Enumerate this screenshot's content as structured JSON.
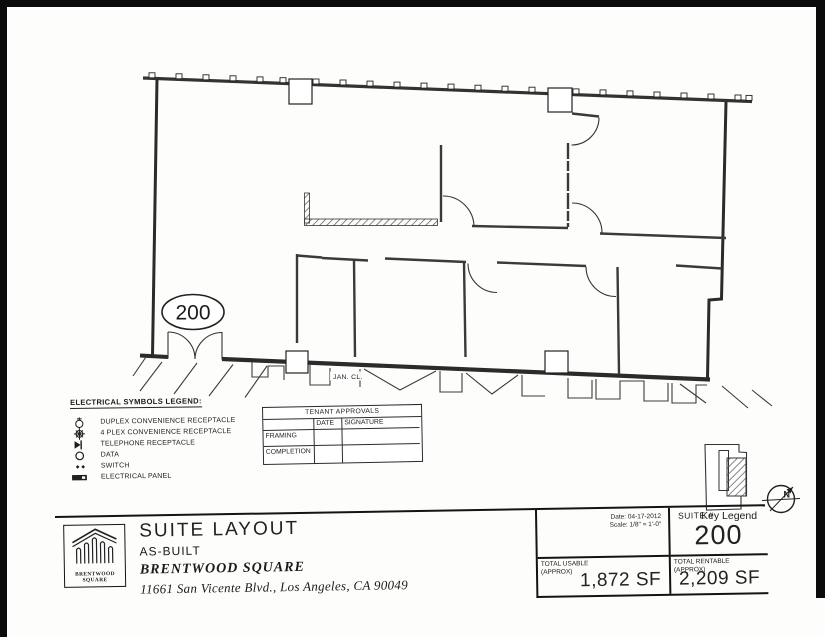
{
  "drawing": {
    "suite_bubble": "200",
    "room_label_jan_closet": "JAN. CL."
  },
  "electrical_legend": {
    "title": "ELECTRICAL SYMBOLS LEGEND:",
    "items": [
      {
        "icon": "duplex-receptacle-symbol",
        "label": "DUPLEX CONVENIENCE RECEPTACLE"
      },
      {
        "icon": "quad-receptacle-symbol",
        "label": "4 PLEX CONVENIENCE RECEPTACLE"
      },
      {
        "icon": "telephone-receptacle-symbol",
        "label": "TELEPHONE RECEPTACLE"
      },
      {
        "icon": "data-symbol",
        "label": "DATA"
      },
      {
        "icon": "switch-symbol",
        "label": "SWITCH"
      },
      {
        "icon": "electrical-panel-symbol",
        "label": "ELECTRICAL PANEL"
      }
    ]
  },
  "tenant_approvals": {
    "title": "TENANT APPROVALS",
    "col_date": "DATE",
    "col_signature": "SIGNATURE",
    "row_framing": "FRAMING",
    "row_completion": "COMPLETION"
  },
  "key_legend": {
    "label": "Key Legend"
  },
  "compass": {
    "north": "N"
  },
  "title_block": {
    "logo_line1": "BRENTWOOD",
    "logo_line2": "SQUARE",
    "title": "SUITE LAYOUT",
    "subtitle": "AS-BUILT",
    "property_name": "BRENTWOOD SQUARE",
    "address": "11661 San Vicente Blvd., Los Angeles, CA 90049",
    "date": "Date: 04-17-2012",
    "scale": "Scale: 1/8\" = 1'-0\"",
    "suite_label": "SUITE #",
    "suite_number": "200",
    "usable_label": "TOTAL USABLE",
    "usable_approx": "(APPROX)",
    "usable_value": "1,872 SF",
    "rentable_label": "TOTAL RENTABLE",
    "rentable_approx": "(APPROX)",
    "rentable_value": "2,209 SF"
  }
}
